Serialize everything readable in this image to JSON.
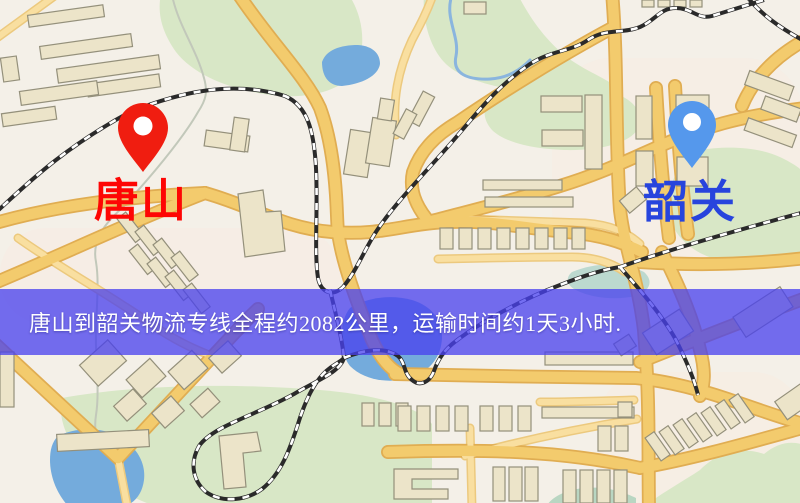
{
  "banner": {
    "text": "唐山到韶关物流专线全程约2082公里，运输时间约1天3小时.",
    "bg_color": "#4640ee",
    "text_color": "#ffffff"
  },
  "route": {
    "origin": "唐山",
    "destination": "韶关",
    "distance_km": "2082",
    "duration": "1天3小时"
  },
  "markers": {
    "origin": {
      "label": "唐山",
      "pin_color": "#f01d10",
      "label_color": "#fe0604"
    },
    "destination": {
      "label": "韶关",
      "pin_color": "#5598ec",
      "label_color": "#2744dd"
    }
  },
  "map": {
    "style_colors": {
      "background": "#f4f0e8",
      "road_fill": "#f3cb6d",
      "road_casing": "#e0ad52",
      "building_fill": "#ece4c9",
      "green_area": "#d8e7c6",
      "water": "#74abdc",
      "railway": "#2a2a2a"
    }
  }
}
